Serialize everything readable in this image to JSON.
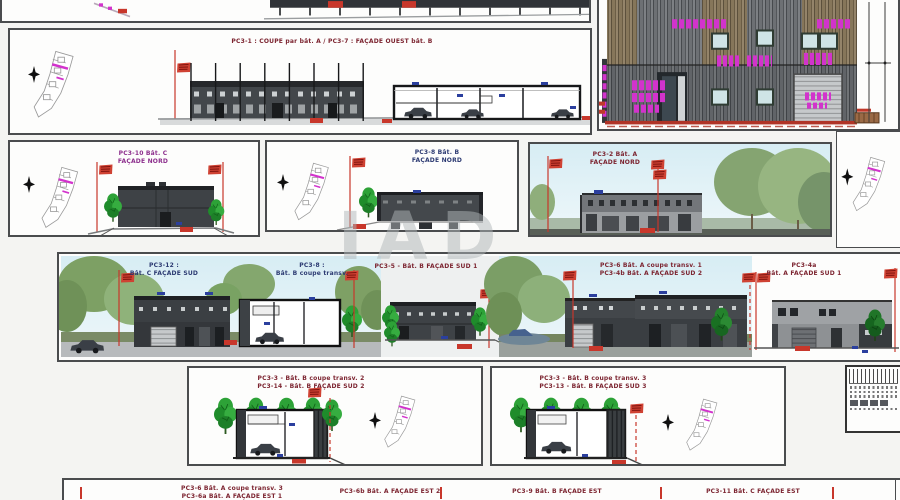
{
  "sheet_type": "permis de construire - planche de façades et coupes",
  "watermark": "IAD",
  "panels": {
    "main": {
      "title": "PC3-1 : COUPE par bât. A   /   PC3-7 : FAÇADE OUEST bât. B"
    },
    "nord_c": {
      "l1": "PC3-10 Bât. C",
      "l2": "FAÇADE NORD"
    },
    "nord_b": {
      "l1": "PC3-8 Bât. B",
      "l2": "FAÇADE NORD"
    },
    "nord_a": {
      "l1": "PC3-2 Bât. A",
      "l2": "FAÇADE NORD"
    },
    "sud_c": {
      "l1": "PC3-12 :",
      "l2": "Bât. C FAÇADE SUD"
    },
    "coupe_b": {
      "l1": "PC3-8 :",
      "l2": "Bât. B coupe transv."
    },
    "sud_b1": {
      "title": "PC3-5 - Bât. B FAÇADE SUD 1"
    },
    "coupe_a1": {
      "l1": "PC3-6 Bât. A coupe transv. 1",
      "l2": "PC3-4b Bât. A FAÇADE SUD 2"
    },
    "sud_a1": {
      "l1": "PC3-4a",
      "l2": "Bât. A FAÇADE SUD 1"
    },
    "coupe_2": {
      "l1": "PC3-3 - Bât. B coupe transv. 2",
      "l2": "PC3-14 - Bât. B FAÇADE SUD 2"
    },
    "coupe_3": {
      "l1": "PC3-3 - Bât. B coupe transv. 3",
      "l2": "PC3-13 - Bât. B FAÇADE SUD 3"
    },
    "est1": {
      "l1": "PC3-6 Bât. A coupe transv. 3",
      "l2": "PC3-6a Bât. A FAÇADE EST 1"
    },
    "est2": {
      "title": "PC3-6b Bât. A FAÇADE EST 2"
    },
    "est3": {
      "title": "PC3-9 Bât. B FAÇADE EST"
    },
    "est4": {
      "title": "PC3-11 Bât. C FAÇADE EST"
    }
  },
  "colors": {
    "dimension_red": "#c8372b",
    "annotation_magenta": "#d233cc",
    "note_blue": "#2b3f9e",
    "title_red": "#7c2430",
    "title_navy": "#2c3a72",
    "building_dark": "#3f4246",
    "sky": "#d7edf4"
  }
}
